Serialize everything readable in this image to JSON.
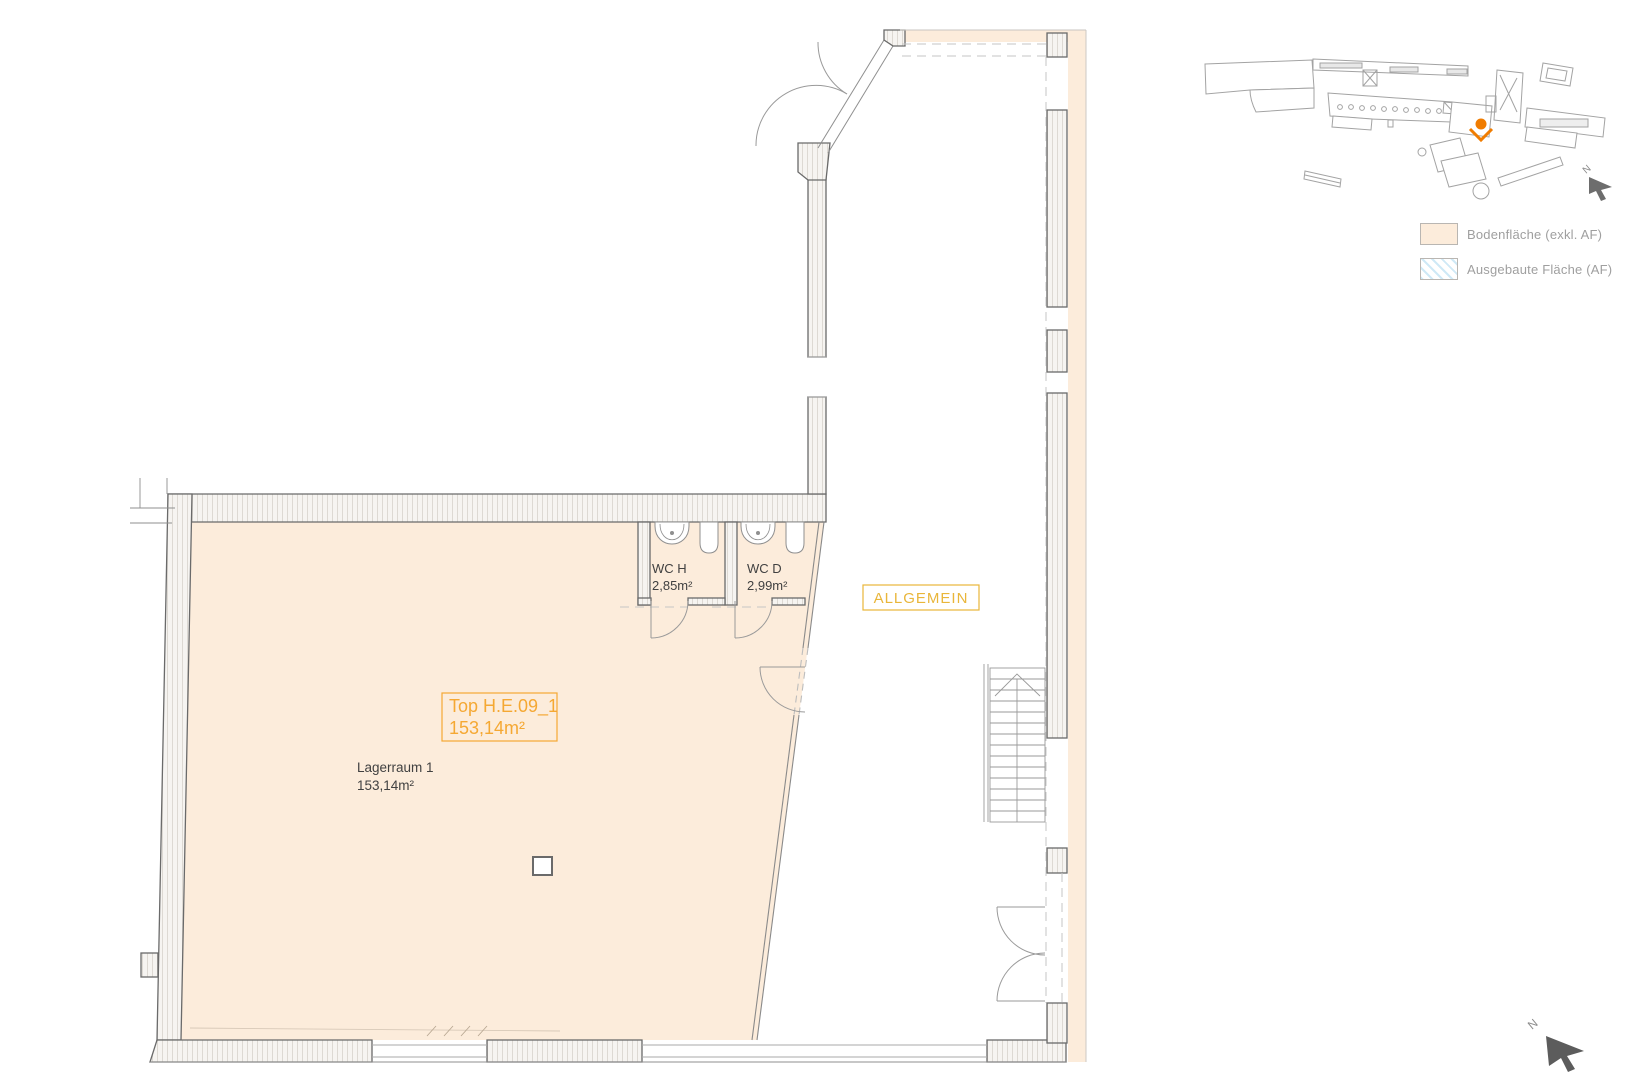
{
  "plan": {
    "unit": {
      "line1": "Top H.E.09_1",
      "line2": "153,14m²"
    },
    "room": {
      "name": "Lagerraum 1",
      "area": "153,14m²"
    },
    "wc_h": {
      "name": "WC H",
      "area": "2,85m²"
    },
    "wc_d": {
      "name": "WC D",
      "area": "2,99m²"
    },
    "common_area_label": "ALLGEMEIN",
    "north_label": "N"
  },
  "minimap": {
    "north_label": "N"
  },
  "legend": {
    "items": [
      {
        "label": "Bodenfläche (exkl. AF)",
        "swatch": "solid",
        "color": "#fcecdb"
      },
      {
        "label": "Ausgebaute Fläche (AF)",
        "swatch": "hatched",
        "color": "#cfe9f6"
      }
    ]
  },
  "colors": {
    "floor": "#fcecdb",
    "accent_orange": "#f5a833",
    "allgemein_yellow": "#e9b63a",
    "marker_orange": "#f07c00",
    "wall_stroke": "#6a6a6a",
    "legend_text": "#9f9f9f"
  }
}
